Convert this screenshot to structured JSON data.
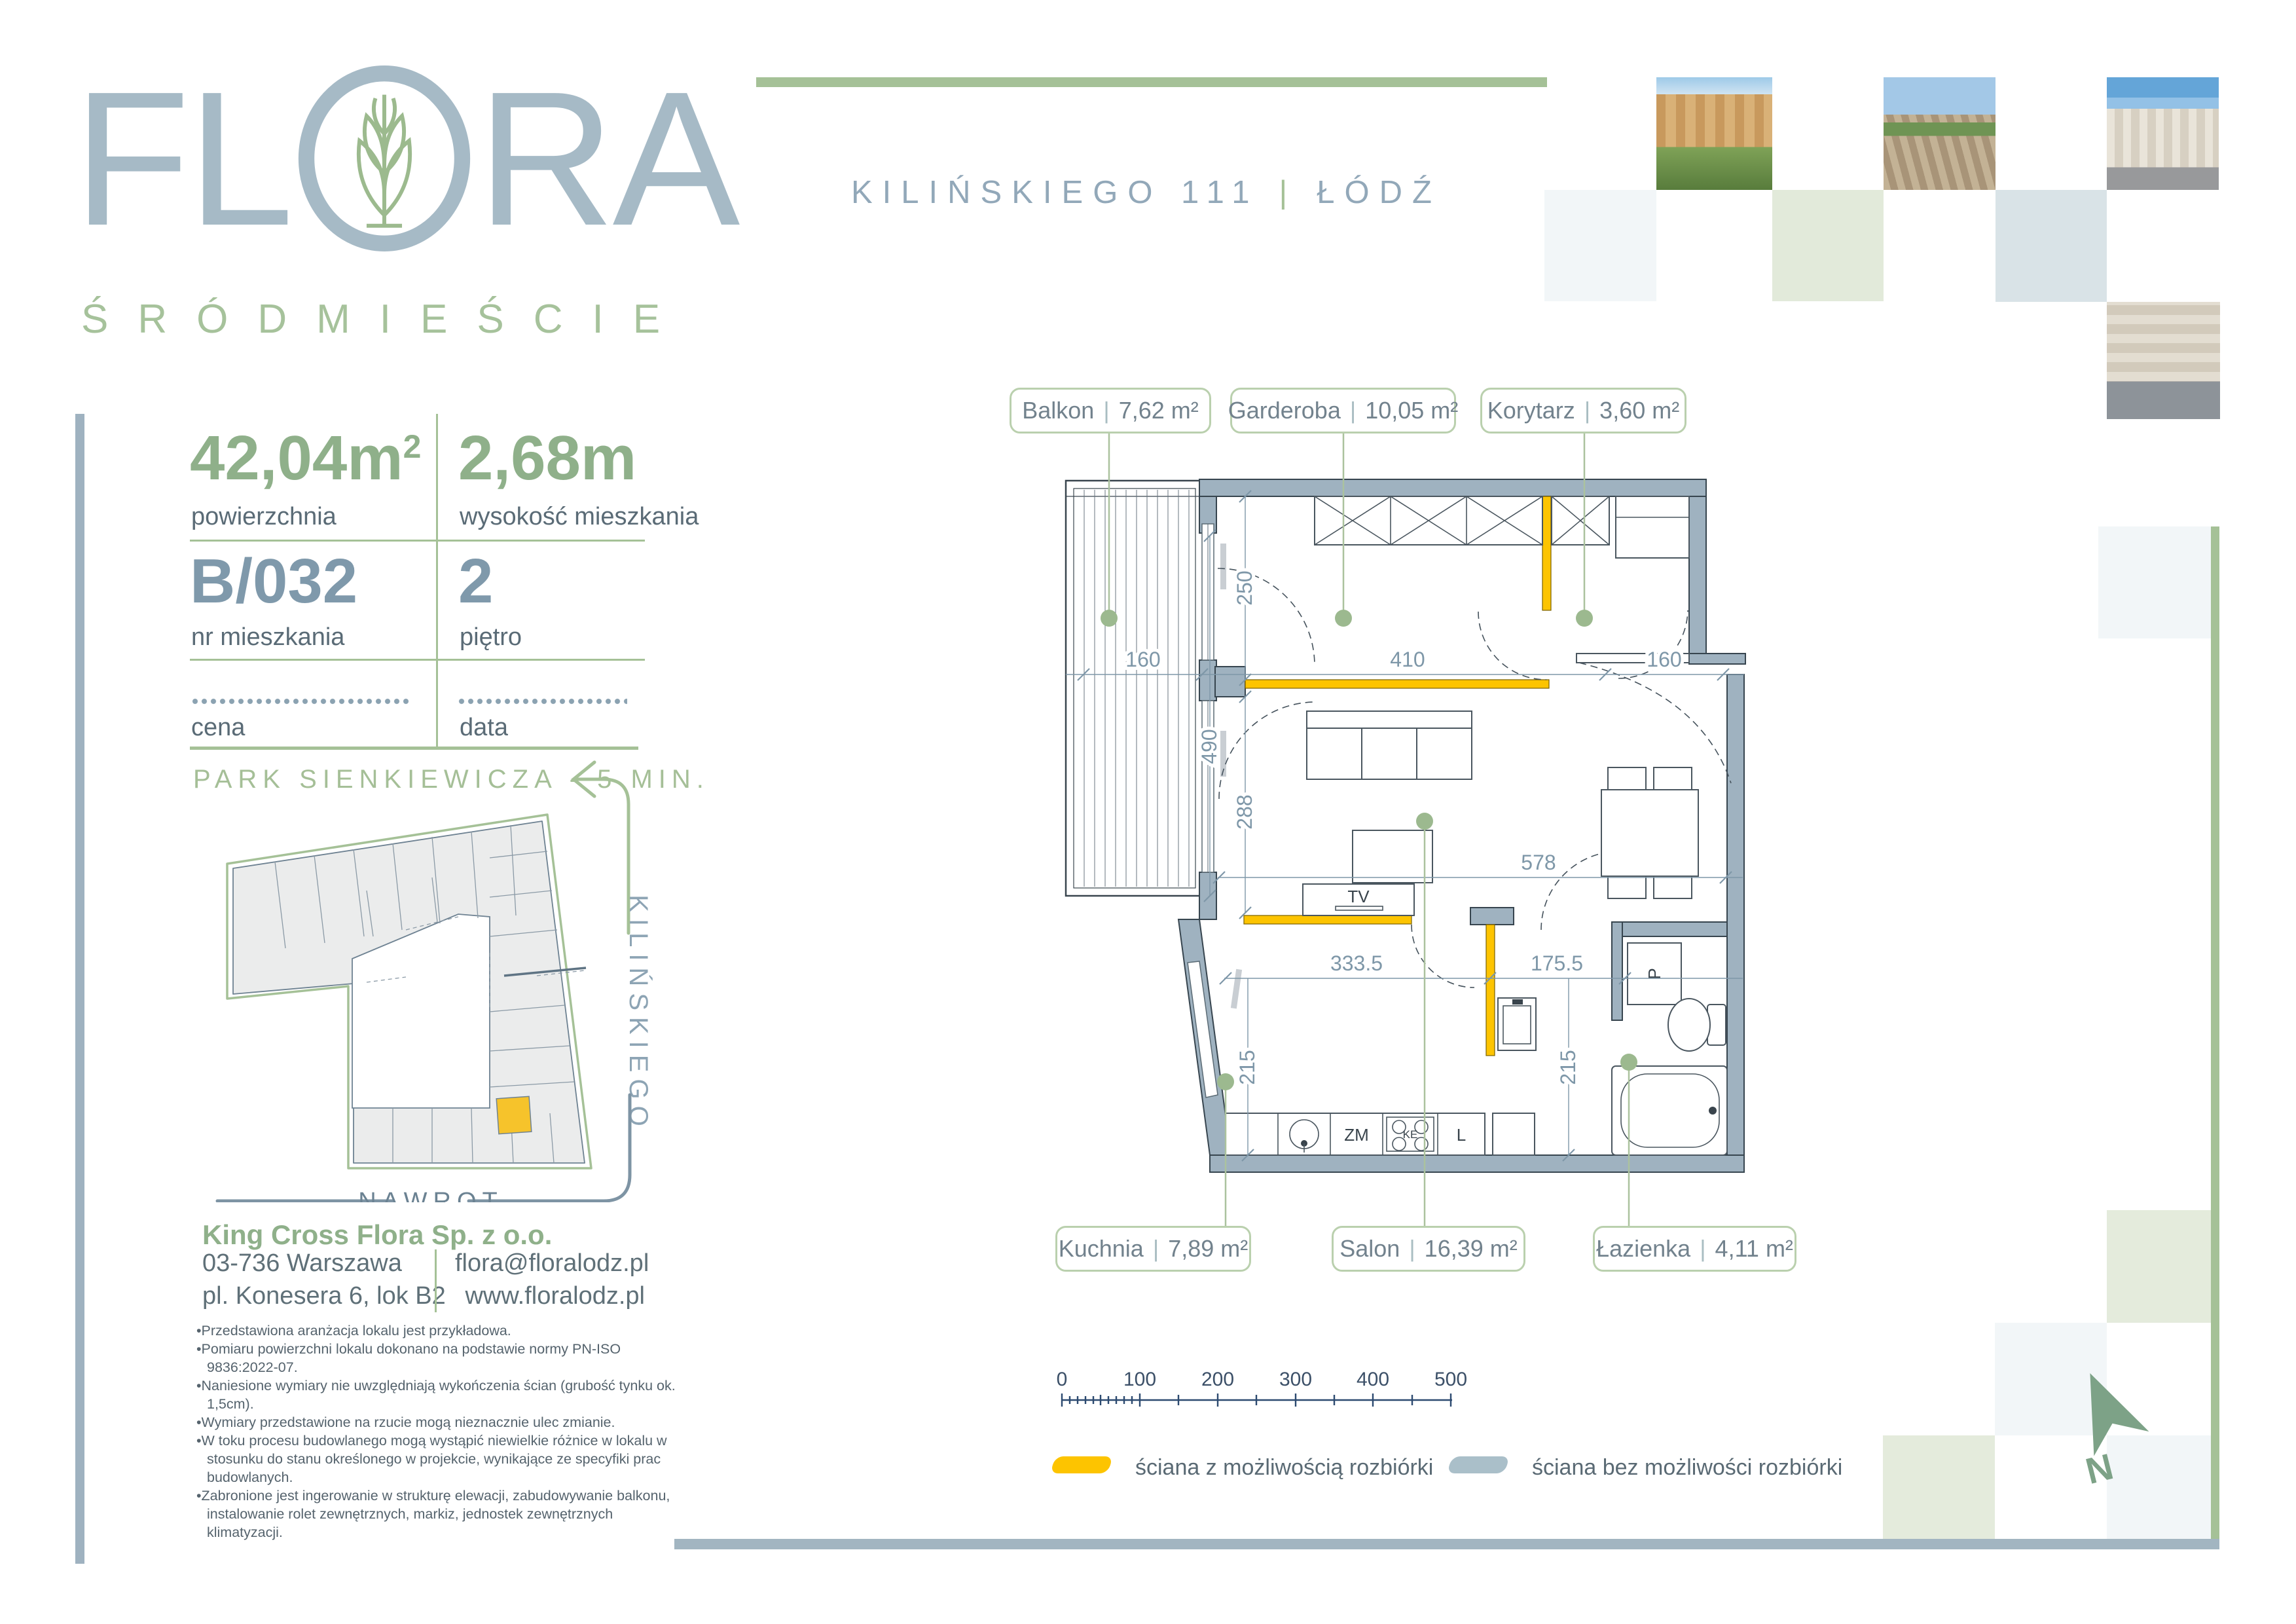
{
  "logo": {
    "left": "FL",
    "right": "RA",
    "subtitle": "ŚRÓDMIEŚCIE"
  },
  "header": {
    "address": "KILIŃSKIEGO 111",
    "sep": "|",
    "city": "ŁÓDŹ"
  },
  "specs": {
    "area": {
      "value": "42,04",
      "unit": "m",
      "sup": "2",
      "label": "powierzchnia"
    },
    "height": {
      "value": "2,68",
      "unit": "m",
      "label": "wysokość mieszkania"
    },
    "unit_no": {
      "value": "B/032",
      "label": "nr mieszkania"
    },
    "floor": {
      "value": "2",
      "label": "piętro"
    },
    "price_label": "cena",
    "date_label": "data"
  },
  "location": {
    "park": "PARK SIENKIEWICZA - 5 MIN.",
    "street_side": "KILIŃSKIEGO",
    "street_bottom": "NAWROT"
  },
  "company": {
    "name": "King Cross Flora Sp. z o.o.",
    "postal_city": "03-736  Warszawa",
    "street": "pl. Konesera 6, lok B2",
    "email": "flora@floralodz.pl",
    "website": "www.floralodz.pl"
  },
  "notes": [
    "Przedstawiona aranżacja lokalu jest przykładowa.",
    "Pomiaru powierzchni lokalu dokonano na podstawie normy PN-ISO 9836:2022-07.",
    "Naniesione wymiary nie uwzględniają wykończenia ścian (grubość tynku ok. 1,5cm).",
    "Wymiary przedstawione na rzucie mogą nieznacznie ulec zmianie.",
    "W toku procesu budowlanego mogą wystąpić niewielkie różnice w lokalu w stosunku do stanu określonego w projekcie, wynikające ze specyfiki prac budowlanych.",
    "Zabronione jest ingerowanie w strukturę elewacji, zabudowywanie balkonu, instalowanie rolet zewnętrznych, markiz, jednostek zewnętrznych klimatyzacji."
  ],
  "plan": {
    "sep": "|",
    "rooms": [
      {
        "name": "Balkon",
        "area": "7,62 m²"
      },
      {
        "name": "Garderoba",
        "area": "10,05 m²"
      },
      {
        "name": "Korytarz",
        "area": "3,60 m²"
      },
      {
        "name": "Kuchnia",
        "area": "7,89 m²"
      },
      {
        "name": "Salon",
        "area": "16,39 m²"
      },
      {
        "name": "Łazienka",
        "area": "4,11 m²"
      }
    ],
    "dims": {
      "d160l": "160",
      "d410": "410",
      "d160r": "160",
      "d490": "490",
      "d250": "250",
      "d288": "288",
      "d578": "578",
      "d3335": "333.5",
      "d1755": "175.5",
      "d215l": "215",
      "d215r": "215"
    },
    "fixtures": {
      "tv": "TV",
      "zm": "ZM",
      "ke": "KE",
      "l": "L",
      "p": "P"
    },
    "scale": [
      "0",
      "100",
      "200",
      "300",
      "400",
      "500"
    ]
  },
  "legend": {
    "removable": "ściana z możliwością rozbiórki",
    "fixed": "ściana bez możliwości rozbiórki"
  },
  "north": {
    "label": "N"
  },
  "colors": {
    "accent_green": "#a5c197",
    "wall_gray": "#9fb2c0",
    "removable_yellow": "#fdc400",
    "legend_gray": "#aabfc9",
    "number_green": "#8fb08a",
    "number_blue": "#7f99ab",
    "unit_yellow": "#f6c32b"
  }
}
